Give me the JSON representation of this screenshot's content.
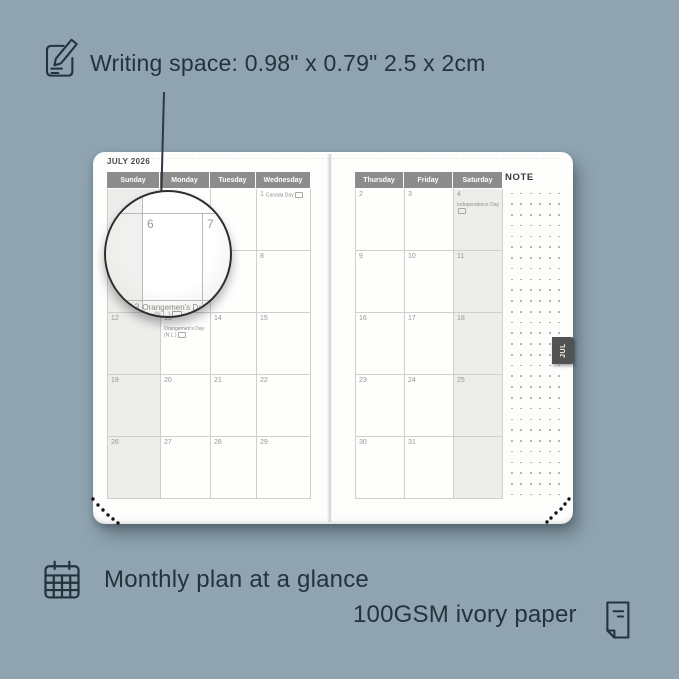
{
  "background_color": "#8fa4b0",
  "annotations": {
    "writing_space": "Writing space: 0.98\" x 0.79\"  2.5 x 2cm",
    "monthly_plan": "Monthly plan at a glance",
    "paper": "100GSM ivory paper"
  },
  "planner": {
    "month_title": "JULY 2026",
    "note_label": "NOTE",
    "tab_label": "JUL",
    "left_page": {
      "shaded_column": "Sunday",
      "headers": [
        "Sunday",
        "Monday",
        "Tuesday",
        "Wednesday"
      ],
      "rows": [
        [
          {
            "day": ""
          },
          {
            "day": ""
          },
          {
            "day": ""
          },
          {
            "day": "1",
            "event": "Canada Day",
            "flag": true
          }
        ],
        [
          {
            "day": "5"
          },
          {
            "day": "6"
          },
          {
            "day": "7"
          },
          {
            "day": "8"
          }
        ],
        [
          {
            "day": "12"
          },
          {
            "day": "13",
            "event": "Orangemen's Day (N.L.)",
            "flag": true
          },
          {
            "day": "14"
          },
          {
            "day": "15"
          }
        ],
        [
          {
            "day": "19"
          },
          {
            "day": "20"
          },
          {
            "day": "21"
          },
          {
            "day": "22"
          }
        ],
        [
          {
            "day": "26"
          },
          {
            "day": "27"
          },
          {
            "day": "28"
          },
          {
            "day": "29"
          }
        ]
      ]
    },
    "right_page": {
      "shaded_column": "Saturday",
      "headers": [
        "Thursday",
        "Friday",
        "Saturday"
      ],
      "rows": [
        [
          {
            "day": "2"
          },
          {
            "day": "3"
          },
          {
            "day": "4",
            "event": "Independence Day",
            "flag": true
          }
        ],
        [
          {
            "day": "9"
          },
          {
            "day": "10"
          },
          {
            "day": "11"
          }
        ],
        [
          {
            "day": "16"
          },
          {
            "day": "17"
          },
          {
            "day": "18"
          }
        ],
        [
          {
            "day": "23"
          },
          {
            "day": "24"
          },
          {
            "day": "25"
          }
        ],
        [
          {
            "day": "30"
          },
          {
            "day": "31"
          },
          {
            "day": ""
          }
        ]
      ]
    }
  },
  "magnifier": {
    "day_a": "6",
    "day_b": "7",
    "event_day": "13",
    "event_name": "Orangemen's Day",
    "event_region": "(N.L.)"
  },
  "colors": {
    "background": "#8fa4b0",
    "annotation_text": "#25323d",
    "page": "#fdfdfc",
    "header_bar": "#8c8c8c",
    "shaded_column": "#ededeb",
    "tab": "#525252"
  }
}
